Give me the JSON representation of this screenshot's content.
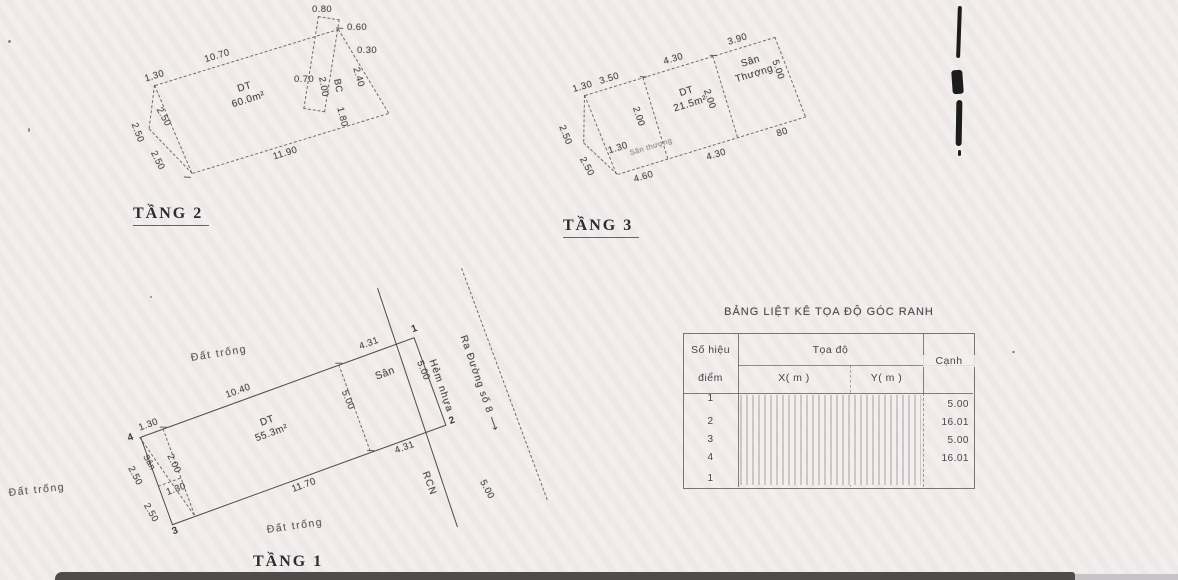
{
  "colors": {
    "paper": "#f3eeee",
    "ink": "#474444",
    "table_line": "#6a5c5c",
    "window_bar": "#4f4c4c"
  },
  "floor2": {
    "title": "TẦNG 2",
    "dt": "DT",
    "area": "60.0m²",
    "dim_top": "10.70",
    "dim_bottom": "11.90",
    "dim_left_top": "1.30",
    "dim_left_a": "2.50",
    "dim_left_b": "2.50",
    "dim_left_c": "2.50",
    "bal_1": "0.80",
    "bal_2": "0.60",
    "bal_3": "0.30",
    "bal_4": "0.70",
    "bal_5": "2.00",
    "bal_6": "BC",
    "bal_7": "2.40",
    "bal_8": "1.80"
  },
  "floor3": {
    "title": "TẦNG 3",
    "dt": "DT",
    "area": "21.5m²",
    "terrace": "Sân Thượng",
    "faint_label": "Sân thượng",
    "dim_top_1": "3.50",
    "dim_top_2": "4.30",
    "dim_top_3": "3.90",
    "dim_left_top": "1.30",
    "dim_left_a": "2.50",
    "dim_left_b": "2.50",
    "dim_inner": "1.30",
    "dim_div_1": "2.00",
    "dim_div_2": "2.00",
    "dim_right": "5.00",
    "dim_bottom_1": "4.60",
    "dim_bottom_2": "4.30",
    "dim_bottom_right": "80"
  },
  "floor1": {
    "title": "TẦNG 1",
    "dt": "DT",
    "area": "55.3m²",
    "yard_main": "Sân",
    "yard_left": "Sân",
    "empty_top": "Đất trống",
    "empty_left": "Đất trống",
    "empty_bottom": "Đất trống",
    "dim_top_1": "10.40",
    "dim_top_2": "4.31",
    "dim_right": "5.00",
    "dim_div": "5.00",
    "dim_yard_bottom": "4.31",
    "dim_bottom": "11.70",
    "dim_left_top": "1.30",
    "dim_left_a": "2.50",
    "dim_left_b": "2.00",
    "dim_left_c": "1.30",
    "dim_left_d": "2.50",
    "pt1": "1",
    "pt2": "2",
    "pt3": "3",
    "pt4": "4"
  },
  "street": {
    "road": "Ra Đường số 8 ⟶",
    "alley": "Hẻm nhựa",
    "rcn": "RCN",
    "width": "5.00"
  },
  "table": {
    "title": "BẢNG LIỆT KÊ TỌA ĐỘ GÓC RANH",
    "col_point_l1": "Số hiệu",
    "col_point_l2": "điểm",
    "col_coord": "Tọa độ",
    "col_x": "X( m )",
    "col_y": "Y( m )",
    "col_edge": "Cạnh",
    "points": [
      "1",
      "2",
      "3",
      "4",
      "1"
    ],
    "edges": [
      "5.00",
      "16.01",
      "5.00",
      "16.01"
    ]
  }
}
